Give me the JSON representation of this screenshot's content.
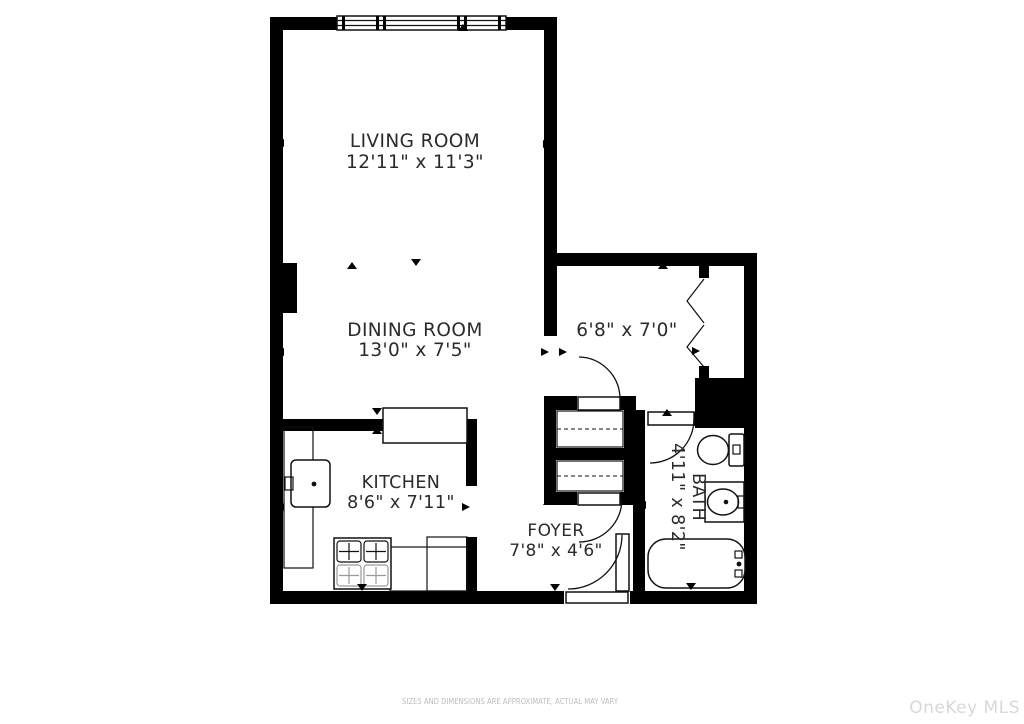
{
  "rooms": {
    "living": {
      "name": "LIVING ROOM",
      "dims": "12'11\" x 11'3\""
    },
    "dining": {
      "name": "DINING ROOM",
      "dims": "13'0\" x 7'5\""
    },
    "kitchen": {
      "name": "KITCHEN",
      "dims": "8'6\" x 7'11\""
    },
    "foyer": {
      "name": "FOYER",
      "dims": "7'8\" x 4'6\""
    },
    "bath": {
      "name": "BATH",
      "dims": "4'11\" x 8'2\""
    },
    "hallway": {
      "dims": "6'8\" x 7'0\""
    }
  },
  "fixtures": [
    "window",
    "hinged-door",
    "entry-door",
    "bifold-closet-door",
    "closet-shelves",
    "toilet",
    "vanity-sink",
    "bathtub",
    "gas-range",
    "kitchen-sink",
    "counter",
    "peninsula-counter"
  ],
  "footer": {
    "disclaimer": "SIZES AND DIMENSIONS ARE APPROXIMATE, ACTUAL MAY VARY",
    "watermark": "OneKey MLS"
  },
  "colors": {
    "background": "#ffffff",
    "wall": "#000000",
    "line": "#111111",
    "label_text": "#2b2b2b",
    "disclaimer_text": "#bdbdbd",
    "watermark_text": "#d8d8d8"
  }
}
